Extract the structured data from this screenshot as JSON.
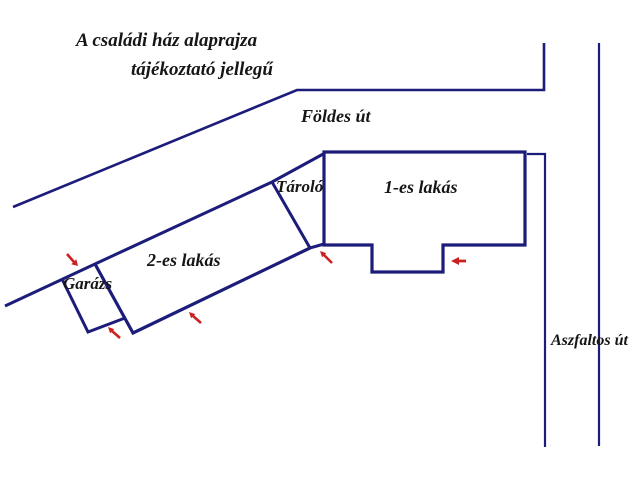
{
  "title": {
    "line1": "A családi ház alaprajza",
    "line2": "tájékoztató jellegű"
  },
  "roads": {
    "north_label": "Földes út",
    "east_label": "Aszfaltos út"
  },
  "buildings": {
    "unit1_label": "1-es lakás",
    "unit2_label": "2-es lakás",
    "storage_label": "Tároló",
    "garage_label": "Garázs"
  },
  "arrows": [
    {
      "name": "garage-top-entrance-arrow",
      "direction": "down-right"
    },
    {
      "name": "garage-bottom-entrance-arrow",
      "direction": "up-left"
    },
    {
      "name": "unit2-entrance-arrow",
      "direction": "up-left"
    },
    {
      "name": "unit1-left-entrance-arrow",
      "direction": "up-left"
    },
    {
      "name": "unit1-porch-entrance-arrow",
      "direction": "left"
    }
  ],
  "colors": {
    "outline": "#1c1c7a",
    "arrow": "#cc2121",
    "ink": "#161616",
    "bg": "#ffffff"
  }
}
